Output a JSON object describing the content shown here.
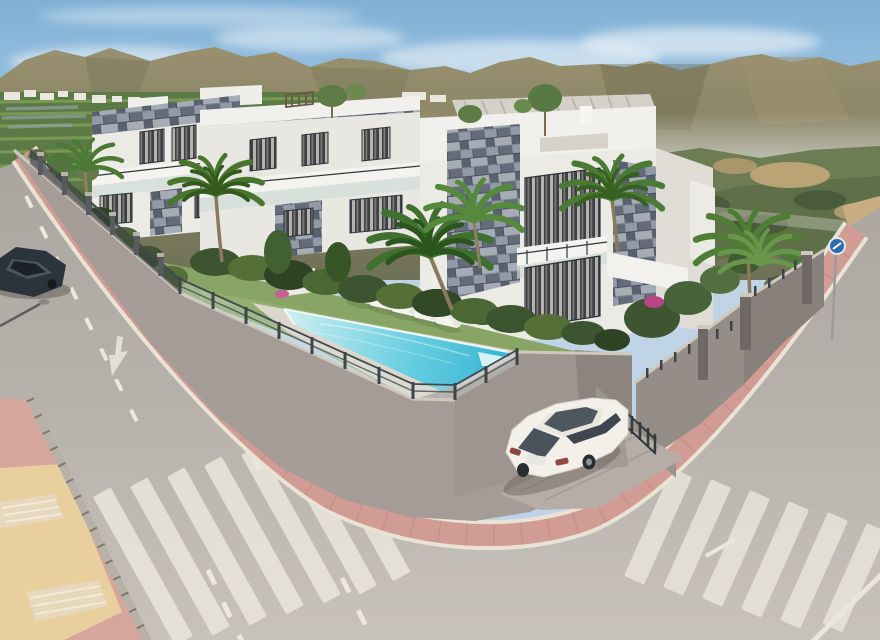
{
  "scene": {
    "aria_label": "Daytime 3D architectural rendering of a modern white apartment complex on a street corner: three white blocks with grey stone cladding and rooftop pergolas, a turquoise communal pool behind a glass fence, six sun loungers on a lawn, palm trees, pink sidewalks wrapping the corner, two zebra crosswalks, a white hatchback parked in the driveway, a dark car parked on the left street, and a brown mountain range with farmland under a blue sky.",
    "style": "photorealistic CGI visualization",
    "time_of_day": "midday",
    "setting": "new-build residential complex on a hillside street corner"
  },
  "objects": {
    "buildings": {
      "count": 3,
      "label": "white apartment blocks with blue-grey stone cladding, glass balconies and rooftop pergolas"
    },
    "pool": {
      "label": "communal swimming pool with tanning shelf",
      "fence": "glass safety fence with dark posts"
    },
    "sun_loungers": {
      "count": 6,
      "label": "white sun loungers on lawn"
    },
    "palm_trees": {
      "count": 6,
      "label": "palm trees in garden and on hillside"
    },
    "rooftop_trees": {
      "count": 3,
      "label": "small olive trees on roof terraces"
    },
    "outdoor_shower": {
      "label": "white pool shower column"
    },
    "flower_bushes": {
      "count": 4,
      "label": "magenta bougainvillea bushes"
    },
    "cars": [
      {
        "label": "white hatchback parked in corner driveway",
        "color_name": "white"
      },
      {
        "label": "dark car parked on left street",
        "color_name": "dark blue-grey"
      }
    ],
    "crosswalks": {
      "count": 2,
      "label": "white zebra crossings"
    },
    "roads": {
      "label": "two asphalt streets meeting at the corner, dashed lane lines, straight-ahead arrow"
    },
    "sidewalks": {
      "label": "pink paved sidewalks with light curbs; corner sidewalk with yellow tactile paving"
    },
    "perimeter": {
      "label": "grey rendered walls topped by glass and metal fencing"
    },
    "street_lamp": {
      "label": "street lamp overhanging left road"
    },
    "traffic_sign": {
      "label": "blue circular traffic sign on pole"
    },
    "background": {
      "label": "brown-green mountain ridge, farmland with village houses, scrub hillside"
    }
  },
  "palette": {
    "sky_top": "#7fb0d6",
    "sky_horizon": "#d9e7f0",
    "cloud": "#ffffff",
    "mountain_light": "#99906f",
    "mountain_dark": "#6f7156",
    "farmland": "#5c7a45",
    "hillside": "#5f6f4a",
    "building_white": "#f1f0ec",
    "stone_cladding": "#7c8492",
    "window_glass": "#3b4148",
    "hedge_green": "#3c5530",
    "lawn_green": "#88a565",
    "pool_shallow": "#cdeff1",
    "pool_deep": "#2fb2d1",
    "pool_deck": "#dcd7cd",
    "wall_grey": "#a69c97",
    "fence_dark": "#3f4449",
    "sidewalk_pink": "#d09c93",
    "curb_light": "#e9e3d5",
    "tactile_yellow": "#e9cf9e",
    "asphalt": "#b6b1ab",
    "road_marking": "#ece8dd",
    "car_white": "#f2f0e9",
    "car_dark": "#2b343d",
    "sign_blue": "#2e6ab0"
  }
}
